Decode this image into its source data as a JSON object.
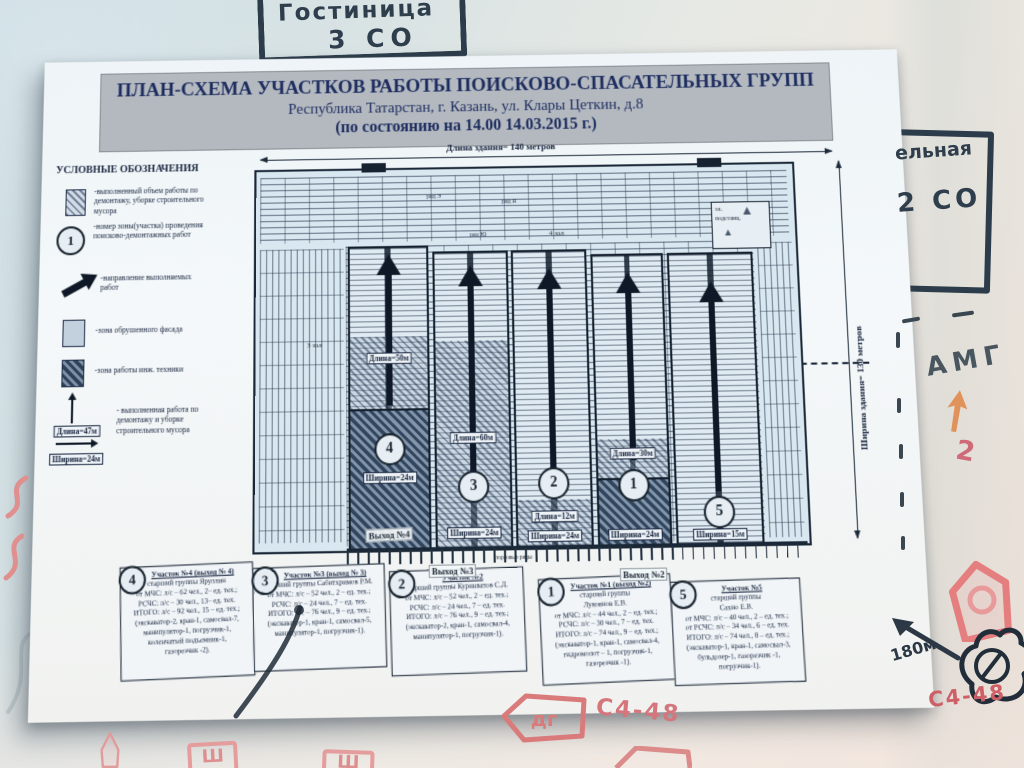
{
  "whiteboard": {
    "top_note_line1": "Гостиница",
    "top_note_line2": "3 СО",
    "right_note_line1": "ельная",
    "right_note_line2": "2 СО",
    "amg": "АМГ",
    "red_two": "2",
    "distance": "180м",
    "c448_right": "С4-48",
    "c448_center": "С4-48",
    "dg": "дг",
    "sh1": "Ш",
    "sh2": "Ш",
    "marker_dark": "#2c3c4a",
    "marker_red": "#d1666e",
    "marker_orange": "#e0894c"
  },
  "poster": {
    "title_line1": "ПЛАН-СХЕМА УЧАСТКОВ РАБОТЫ ПОИСКОВО-СПАСАТЕЛЬНЫХ ГРУПП",
    "title_line2": "Республика Татарстан, г. Казань, ул. Клары Цеткин, д.8",
    "title_line3": "(по состоянию на 14.00 14.03.2015 г.)",
    "legend": {
      "heading": "УСЛОВНЫЕ ОБОЗНАЧЕНИЯ",
      "item1": "-выполненный объем работы по демонтажу, уборке строительного мусора",
      "item2_badge": "1",
      "item2": "-номер зоны(участка) проведения поисково-демонтажных работ",
      "item3": "-направление выполняемых работ",
      "item4": "-зона обрушенного фасада",
      "item5": "-зона работы инж. техники",
      "item6": "- выполненная работа по демонтажу и уборке строительного мусора",
      "item6_len": "Длина=47м",
      "item6_wid": "Ширина=24м"
    },
    "plan": {
      "length_label": "Длина здания= 140 метров",
      "width_label": "Ширина здания= 130 метров",
      "hall3": "3 зал",
      "hall4": "4 зал",
      "hall1": "1 зал",
      "row_e": "ряд Э",
      "row_yu": "ряд Ю",
      "row_ya": "ряд Я",
      "substation_line1": "эл.",
      "substation_line2": "подстанц.",
      "exit4": "Выход №4",
      "exit3": "Выход №3",
      "exit2": "Выход №2",
      "trade_rows": "торговые ряды",
      "zones": [
        {
          "num": "4",
          "len": "Длина=50м",
          "wid": "Ширина=24м"
        },
        {
          "num": "3",
          "len": "Длина=60м",
          "wid": "Ширина=24м"
        },
        {
          "num": "2",
          "len": "Длина=12м",
          "wid": "Ширина=24м"
        },
        {
          "num": "1",
          "len": "Длина=30м",
          "wid": "Ширина=24м"
        },
        {
          "num": "5",
          "len": "",
          "wid": "Ширина=15м"
        }
      ]
    },
    "groups": [
      {
        "num": "4",
        "title": "Участок №4 (выход № 4)",
        "body": "старший группы Яруллин\nот МЧС: л/с – 62 чел., 2– ед. тех.;\nРСЧС: л/с – 30 чел., 13– ед. тех.\nИТОГО: л/с – 92 чел., 15 – ед. тех.;\n(экскаватор-2, кран-1, самосвал-7,\nманипулятор-1, погрузчик-1,\nколенчатый подъемник-1,\nгазорезчик -2)."
      },
      {
        "num": "3",
        "title": "Участок №3 (выход № 3)",
        "body": "старший группы Сабитхримов Р.М.\nот МЧС: л/с – 52 чел., 2 – ед. тех.;\nРСЧС: л/с – 24 чел., 7 – ед. тех.\nИТОГО: л/с – 76 чел., 9 – ед. тех.;\n(экскаватор-1, кран-1, самосвал-5,\nманипулятор-1, погрузчик-1)."
      },
      {
        "num": "2",
        "title": "Участок №2",
        "body": "старший группы Куринватов С.Д.\nот МЧС: л/с – 52 чел., 2 – ед. тех.;\nРСЧС: л/с – 24 чел., 7 – ед. тех.\nИТОГО: л/с – 76 чел., 9 – ед. тех.;\n(экскаватор-2, кран-1, самосвал-4,\nманипулятор-1, погрузчик-1)."
      },
      {
        "num": "1",
        "title": "Участок №1 (выход №2)",
        "body": "старший группы\nЛукоянов Е.В.\nот МЧС: л/с – 44 чел., 2 – ед. тех.;\nРСЧС: л/с – 30 чел., 7 – ед. тех.\nИТОГО: л/с – 74 чел., 9 – ед. тех.;\n(экскаватор-1, кран-1, самосвал-4,\nгидромолот – 1, погрузчик-1,\nгазорезчик -1)."
      },
      {
        "num": "5",
        "title": "Участок №5",
        "body": "старший группы\nСахно Е.В.\nот МЧС: л/с – 40 чел., 2 – ед. тех.;\nот РСЧС: л/с – 34 чел., 6 – ед. тех.\nИТОГО: л/с – 74 чел., 8 – ед. тех.;\n(экскаватор-1, кран-1, самосвал-3,\nбульдозер-1, газорезчик -1,\nпогрузчик-1)."
      }
    ]
  }
}
